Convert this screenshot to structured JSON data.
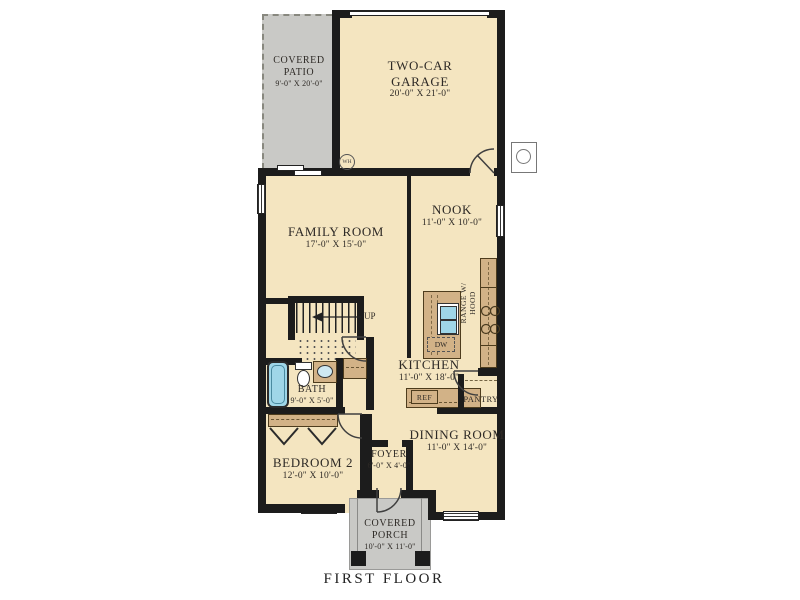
{
  "title": "FIRST FLOOR",
  "rooms": {
    "patio": {
      "line1": "COVERED",
      "line2": "PATIO",
      "dims": "9'-0\" X 20'-0\""
    },
    "garage": {
      "line1": "TWO-CAR",
      "line2": "GARAGE",
      "dims": "20'-0\" X 21'-0\""
    },
    "family": {
      "name": "FAMILY ROOM",
      "dims": "17'-0\" X 15'-0\""
    },
    "nook": {
      "name": "NOOK",
      "dims": "11'-0\" X 10'-0\""
    },
    "kitchen": {
      "name": "KITCHEN",
      "dims": "11'-0\" X 18'-0\""
    },
    "bath": {
      "name": "BATH",
      "dims": "9'-0\" X 5'-0\""
    },
    "bedroom2": {
      "name": "BEDROOM 2",
      "dims": "12'-0\" X 10'-0\""
    },
    "foyer": {
      "name": "FOYER",
      "dims": "6'-0\" X 4'-0\""
    },
    "dining": {
      "name": "DINING ROOM",
      "dims": "11'-0\" X 14'-0\""
    },
    "porch": {
      "line1": "COVERED",
      "line2": "PORCH",
      "dims": "10'-0\" X 11'-0\""
    }
  },
  "fixtures": {
    "water_heater": "WH",
    "dishwasher": "DW",
    "refrigerator": "REF",
    "pantry": "PANTRY",
    "range_line1": "RANGE W/",
    "range_line2": "HOOD",
    "stairs_direction": "UP"
  },
  "colors": {
    "wall": "#1C1C1C",
    "floor": "#F4E5C0",
    "counter": "#D2B287",
    "patio_gray": "#C9C9C6",
    "fixture_blue": "#9FD6E8",
    "text": "#2E2A26"
  }
}
